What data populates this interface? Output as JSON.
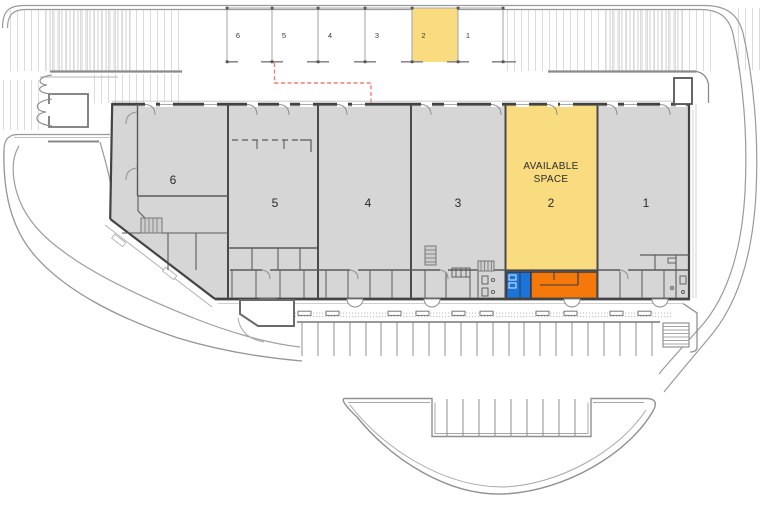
{
  "plan": {
    "garage_row": {
      "units": [
        {
          "number": "6",
          "highlighted": false
        },
        {
          "number": "5",
          "highlighted": false
        },
        {
          "number": "4",
          "highlighted": false
        },
        {
          "number": "3",
          "highlighted": false
        },
        {
          "number": "2",
          "highlighted": true
        },
        {
          "number": "1",
          "highlighted": false
        }
      ]
    },
    "building": {
      "units": [
        {
          "number": "6",
          "highlighted": false
        },
        {
          "number": "5",
          "highlighted": false
        },
        {
          "number": "4",
          "highlighted": false
        },
        {
          "number": "3",
          "highlighted": false
        },
        {
          "number": "2",
          "highlighted": true
        },
        {
          "number": "1",
          "highlighted": false
        }
      ],
      "available_space": {
        "line1": "AVAILABLE",
        "line2": "SPACE"
      }
    },
    "colors": {
      "available_yellow": "#FADC80",
      "suite_blue": "#1D74D8",
      "suite_orange": "#F5790A",
      "building_gray": "#D6D6D6",
      "leader_red": "#EE7F72"
    }
  }
}
